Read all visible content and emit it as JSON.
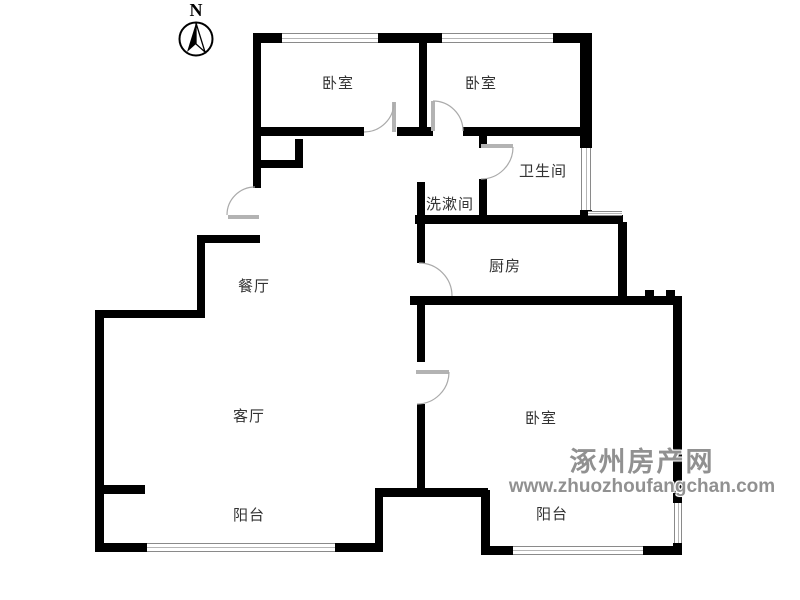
{
  "compass": {
    "letter": "N"
  },
  "rooms": {
    "bedroom_top_left": {
      "label": "卧室"
    },
    "bedroom_top_right": {
      "label": "卧室"
    },
    "bathroom": {
      "label": "卫生间"
    },
    "washroom": {
      "label": "洗漱间"
    },
    "kitchen": {
      "label": "厨房"
    },
    "dining": {
      "label": "餐厅"
    },
    "living": {
      "label": "客厅"
    },
    "balcony_left": {
      "label": "阳台"
    },
    "bedroom_right": {
      "label": "卧室"
    },
    "balcony_right": {
      "label": "阳台"
    }
  },
  "watermark": {
    "site_name": "涿州房产网",
    "site_url": "www.zhuozhoufangchan.com",
    "color": "#919191"
  },
  "colors": {
    "wall": "#000000",
    "door": "#aaaaaa",
    "window_frame": "#8a8a8a"
  }
}
